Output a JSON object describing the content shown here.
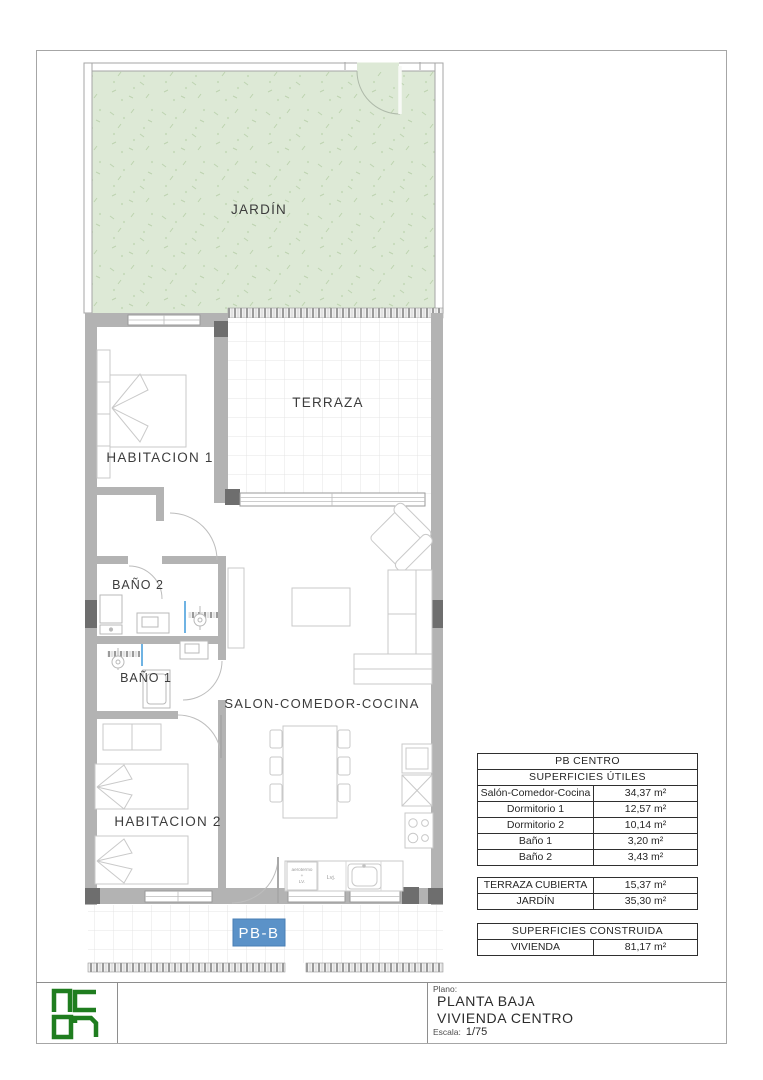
{
  "sheet": {
    "unit_label": "PB-B",
    "rooms": {
      "jardin": "JARDÍN",
      "terraza": "TERRAZA",
      "habitacion1": "HABITACION 1",
      "bano2": "BAÑO 2",
      "bano1": "BAÑO 1",
      "habitacion2": "HABITACION 2",
      "salon": "SALON-COMEDOR-COCINA"
    },
    "annotations": {
      "aerotermo_line1": "aerotermo",
      "aerotermo_line2": "+",
      "aerotermo_line3": "LV.",
      "lavadero": "Lvj."
    }
  },
  "tables": {
    "utiles": {
      "title": "PB CENTRO",
      "subtitle": "SUPERFICIES ÚTILES",
      "rows": [
        {
          "label": "Salón-Comedor-Cocina",
          "value": "34,37 m²"
        },
        {
          "label": "Dormitorio 1",
          "value": "12,57 m²"
        },
        {
          "label": "Dormitorio 2",
          "value": "10,14 m²"
        },
        {
          "label": "Baño 1",
          "value": "3,20 m²"
        },
        {
          "label": "Baño 2",
          "value": "3,43 m²"
        }
      ]
    },
    "exteriores": {
      "rows": [
        {
          "label": "TERRAZA CUBIERTA",
          "value": "15,37 m²"
        },
        {
          "label": "JARDÍN",
          "value": "35,30 m²"
        }
      ]
    },
    "construida": {
      "title": "SUPERFICIES CONSTRUIDA",
      "rows": [
        {
          "label": "VIVIENDA",
          "value": "81,17 m²"
        }
      ]
    }
  },
  "titleblock": {
    "plano_label": "Plano:",
    "plan_name_line1": "PLANTA BAJA",
    "plan_name_line2": "VIVIENDA CENTRO",
    "escala_label": "Escala:",
    "escala_value": "1/75",
    "logo_text": "NC07"
  },
  "colors": {
    "garden_green": "#dde9d6",
    "wall_gray": "#b3b3b3",
    "pillar_gray": "#6e6e6e",
    "unit_badge_blue": "#5b92c8",
    "logo_green": "#1f7d1f"
  }
}
